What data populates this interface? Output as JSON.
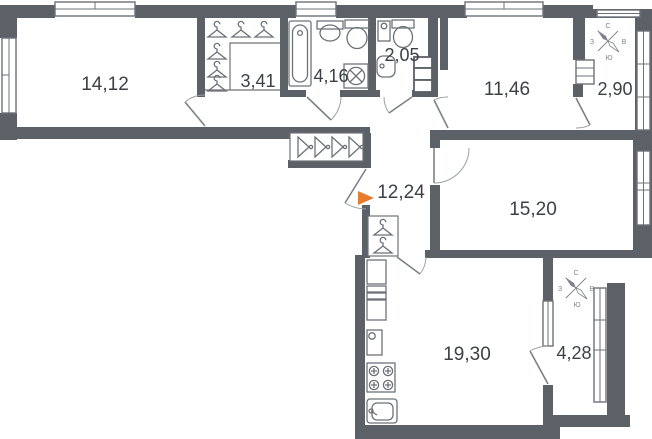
{
  "plan": {
    "rooms": [
      {
        "name": "room-northwest",
        "area": "14,12"
      },
      {
        "name": "wardrobe-closet",
        "area": "3,41"
      },
      {
        "name": "bathroom",
        "area": "4,16"
      },
      {
        "name": "wc",
        "area": "2,05"
      },
      {
        "name": "room-northeast",
        "area": "11,46"
      },
      {
        "name": "balcony-north",
        "area": "2,90"
      },
      {
        "name": "hallway",
        "area": "12,24"
      },
      {
        "name": "room-east",
        "area": "15,20"
      },
      {
        "name": "kitchen",
        "area": "19,30"
      },
      {
        "name": "balcony-south",
        "area": "4,28"
      }
    ],
    "compass": {
      "n": "С",
      "e": "В",
      "s": "Ю",
      "w": "З"
    },
    "colors": {
      "wall": "#5c6167",
      "fixtures": "#6d7278",
      "doors": "#7d8187",
      "text": "#3d4146",
      "entrance_arrow": "#e87c2a"
    },
    "icons": [
      "bathtub-icon",
      "sink-icon",
      "toilet-icon",
      "washing-machine-icon",
      "water-heater-icon",
      "stove-icon",
      "fridge-icon",
      "kitchen-sink-icon",
      "hanger-icon",
      "side-hanger-icon",
      "compass-icon",
      "entrance-arrow-icon",
      "window",
      "door-swing",
      "vent-shaft-icon"
    ]
  }
}
